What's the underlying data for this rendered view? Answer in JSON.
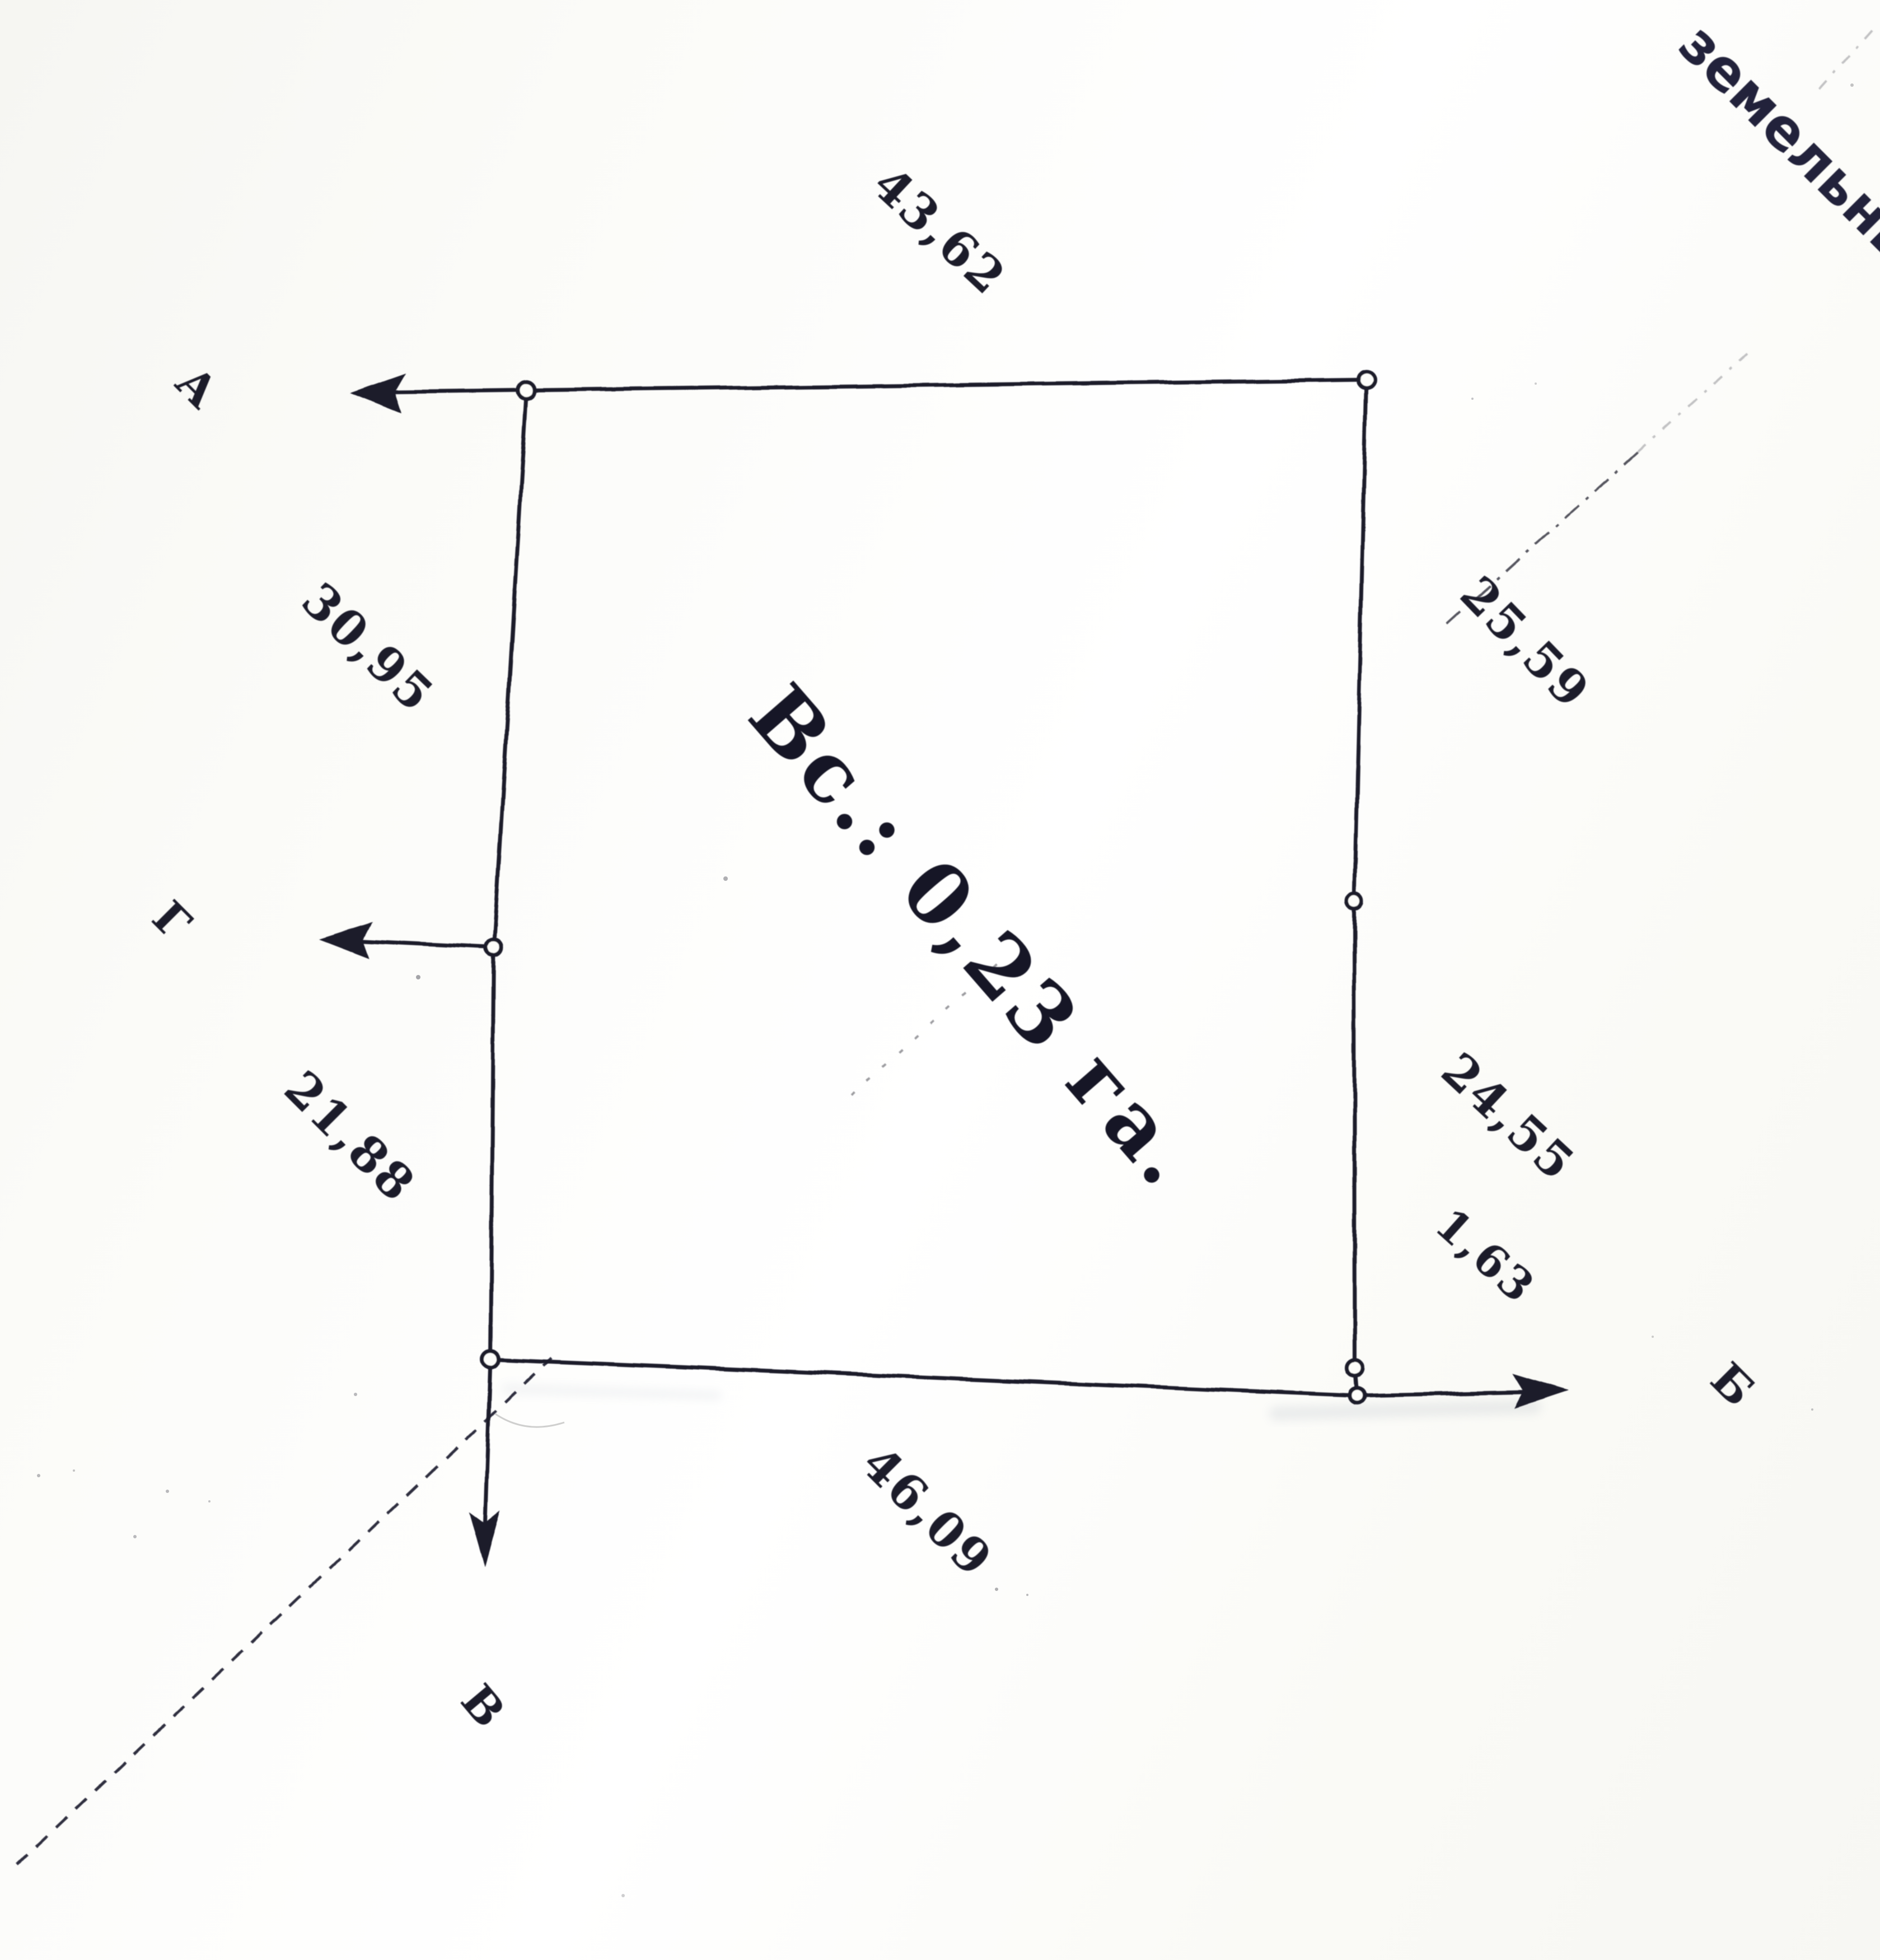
{
  "page": {
    "paper_color": "#fbfaf7",
    "ink_color": "#1b1b2c"
  },
  "stamp_fragment": "земельны",
  "parcel": {
    "area_label": "Вс.: 0,23 га.",
    "corners": {
      "a": "А",
      "b": "Б",
      "v": "В",
      "g": "Г"
    },
    "measurements": {
      "top": "43,62",
      "left_upper": "30,95",
      "left_lower": "21,88",
      "right_upper": "25,59",
      "right_lower": "24,55",
      "right_offset": "1,63",
      "bottom": "46,09"
    }
  }
}
